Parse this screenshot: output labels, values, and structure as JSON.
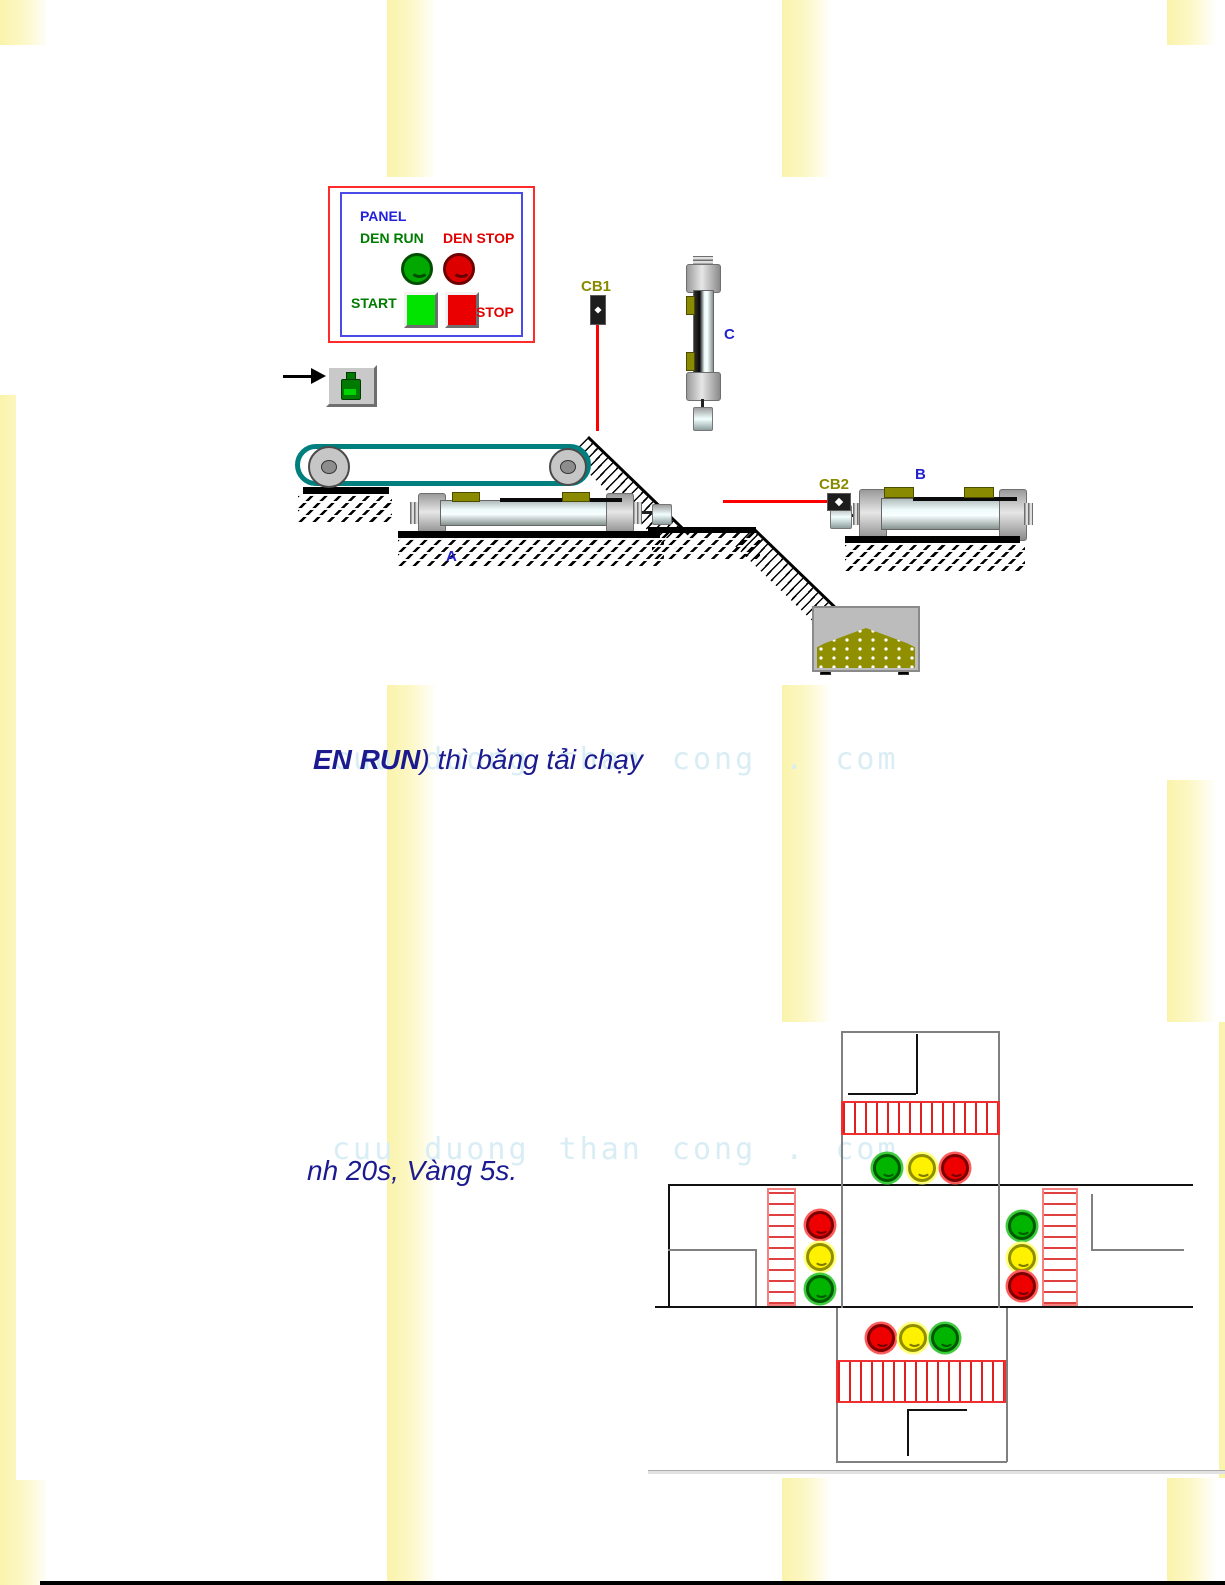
{
  "watermark": {
    "text": "cuu duong than cong . com",
    "color": "#D9EDF5"
  },
  "headings": {
    "line1_bold": "EN RUN",
    "line1_rest": ") thì băng tải chạy",
    "line2": "nh 20s, Vàng 5s.",
    "color": "#1B1B8F"
  },
  "panel": {
    "title": "PANEL",
    "run_lamp_label": "DEN RUN",
    "stop_lamp_label": "DEN STOP",
    "start_button_label": "START",
    "stop_button_label": "STOP",
    "colors": {
      "outer_border": "#FF2A2A",
      "inner_border": "#4A4AE8",
      "title": "#2222DD",
      "run_text": "#007C00",
      "stop_text": "#E00000",
      "run_lamp": "#00A800",
      "stop_lamp": "#DD0000",
      "start_button": "#00E400",
      "stop_button": "#EA0000"
    }
  },
  "sim": {
    "sensor1_label": "CB1",
    "sensor2_label": "CB2",
    "cylinder_a_label": "A",
    "cylinder_b_label": "B",
    "cylinder_c_label": "C",
    "label_color": "#2222CC",
    "sensor_label_color": "#8A8A00",
    "belt_color": "#007F7F",
    "beam_color": "#FF0000",
    "bin_fill_color": "#8F8F00"
  },
  "traffic": {
    "approaches": {
      "north": [
        "green",
        "yellow",
        "red"
      ],
      "west": [
        "red",
        "yellow",
        "green"
      ],
      "east": [
        "green",
        "yellow",
        "red"
      ],
      "south": [
        "red",
        "yellow",
        "green"
      ]
    },
    "colors": {
      "green": "#00B400",
      "yellow": "#FFF200",
      "red": "#EE0000"
    }
  },
  "page": {
    "stripe_color": "#FAF3AC",
    "background": "#FFFFFF"
  }
}
